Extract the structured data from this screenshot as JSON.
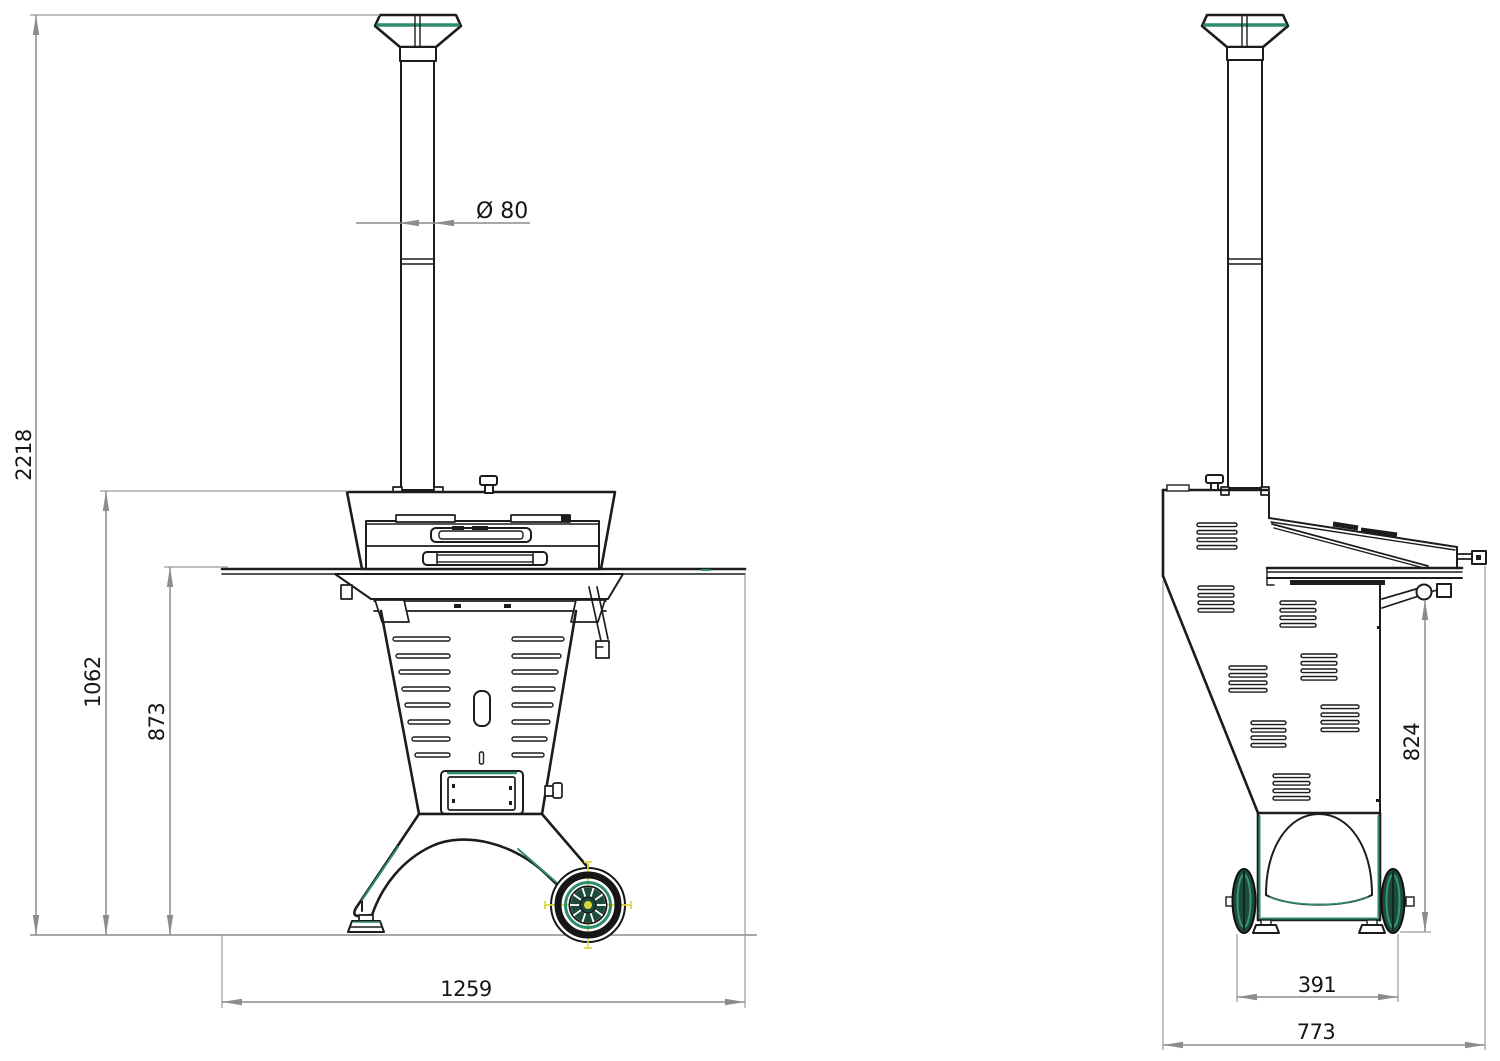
{
  "drawing_type": "technical-dimension-drawing",
  "subject": "wood-pellet outdoor oven, front and side orthographic views",
  "front_view": {
    "total_height": "2218",
    "oven_height": "1062",
    "table_height": "873",
    "table_width": "1259",
    "chimney_diameter": "Ø 80"
  },
  "side_view": {
    "surface_height": "824",
    "wheel_track": "391",
    "total_depth": "773"
  },
  "colors": {
    "outline": "#1c1c1c",
    "dimension_line": "#8c8c8c",
    "accent_green": "#2e8b6e",
    "wheel_dark_green": "#1d4a3d",
    "marker_yellow": "#d8d83a"
  }
}
